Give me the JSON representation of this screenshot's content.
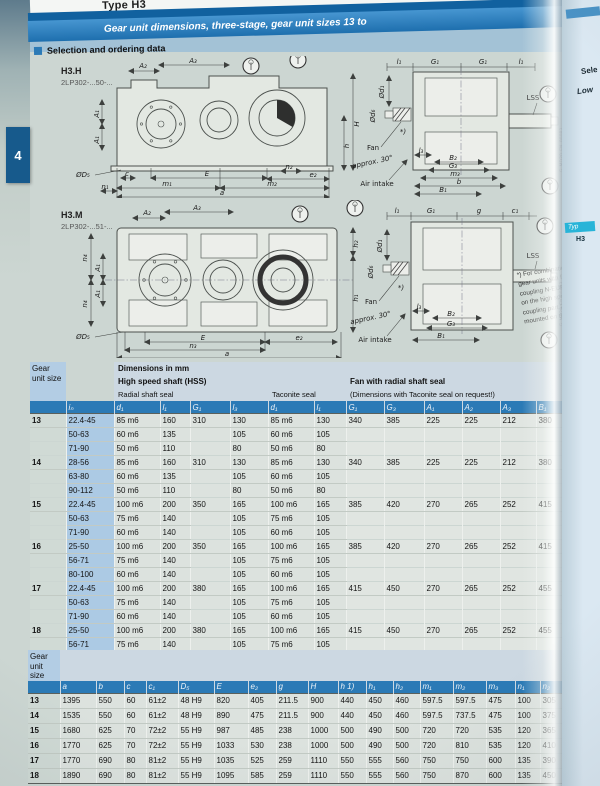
{
  "page": {
    "top_title": "Type H3",
    "banner_title": "Gear unit dimensions, three-stage, gear unit sizes 13 to",
    "section_title": "Selection and ordering data",
    "side_tab": "4",
    "accent_blue": "#2b7ab6",
    "banner_blue": "#2e86c5"
  },
  "next_page": {
    "frag1": "Sele",
    "frag2": "Low",
    "chip": "Typ",
    "chip_sub": "H3"
  },
  "footnote": {
    "lines": [
      "*) For combinations of",
      "gear units with fan and",
      "coupling N-EUPEX-H",
      "on the high speed shaft",
      "coupling part 2/8 must be",
      "mounted on the motor shaft"
    ]
  },
  "drawings": {
    "h3h": {
      "name": "H3.H",
      "code": "2LP302-...50-...",
      "ref": "G_MD20_EN_00083",
      "labels": {
        "A1": "A₁",
        "A2": "A₂",
        "A3": "A₃",
        "H": "H",
        "h": "h",
        "c": "c",
        "E": "E",
        "n1": "n₁",
        "n2": "n₂",
        "e2": "e₂",
        "D5": "ØD₅",
        "m1": "m₁",
        "m2": "m₂",
        "a": "a",
        "l1": "l₁",
        "G1": "G₁",
        "l3": "l₃",
        "LSS": "LSS",
        "d1": "Ød₁",
        "d6": "Ød₆",
        "fan": "Fan",
        "approx": "approx. 30°",
        "air": "Air intake",
        "B1": "B₁",
        "B2": "B₂",
        "G3": "G₃",
        "m3": "m₃",
        "b": "b",
        "star": "*)"
      }
    },
    "h3m": {
      "name": "H3.M",
      "code": "2LP302-...51-...",
      "ref": "G_MD20_EN_00083",
      "labels": {
        "A1": "A₁",
        "A2": "A₂",
        "A3": "A₃",
        "n4": "n₄",
        "h1": "h₁",
        "h2": "h₂",
        "E": "E",
        "n3": "n₃",
        "e2": "e₂",
        "D5": "ØD₅",
        "a": "a",
        "l1": "l₁",
        "G1": "G₁",
        "g": "g",
        "c1": "c₁",
        "l3": "l₃",
        "LSS": "LSS",
        "d1": "Ød₁",
        "d6": "Ød₆",
        "fan": "Fan",
        "approx": "approx. 30°",
        "air": "Air intake",
        "B1": "B₁",
        "B2": "B₂",
        "G3": "G₃",
        "star": "*)"
      }
    }
  },
  "table1": {
    "corner": "Gear unit size",
    "band1": "Dimensions in mm",
    "band2": "High speed shaft (HSS)",
    "band2b": "Fan with radial shaft seal",
    "band3a": "Radial shaft seal",
    "band3b": "Taconite seal",
    "band3c": "(Dimensions with Taconite seal on request!)",
    "cols": [
      "iₙ",
      "d₁",
      "l₁",
      "G₁",
      "l₃",
      "d₁",
      "l₁",
      "G₁",
      "G₃",
      "A₁",
      "A₂",
      "A₃",
      "B₁",
      "B₂"
    ],
    "rows": [
      [
        "13",
        "22.4-45",
        "85 m6",
        "160",
        "310",
        "130",
        "85 m6",
        "130",
        "340",
        "385",
        "225",
        "225",
        "212",
        "380",
        "195"
      ],
      [
        "",
        "50-63",
        "60 m6",
        "135",
        "",
        "105",
        "60 m6",
        "105",
        "",
        "",
        "",
        "",
        "",
        "",
        ""
      ],
      [
        "",
        "71-90",
        "50 m6",
        "110",
        "",
        "80",
        "50 m6",
        "80",
        "",
        "",
        "",
        "",
        "",
        "",
        ""
      ],
      [
        "14",
        "28-56",
        "85 m6",
        "160",
        "310",
        "130",
        "85 m6",
        "130",
        "340",
        "385",
        "225",
        "225",
        "212",
        "380",
        "195"
      ],
      [
        "",
        "63-80",
        "60 m6",
        "135",
        "",
        "105",
        "60 m6",
        "105",
        "",
        "",
        "",
        "",
        "",
        "",
        ""
      ],
      [
        "",
        "90-112",
        "50 m6",
        "110",
        "",
        "80",
        "50 m6",
        "80",
        "",
        "",
        "",
        "",
        "",
        "",
        ""
      ],
      [
        "15",
        "22.4-45",
        "100 m6",
        "200",
        "350",
        "165",
        "100 m6",
        "165",
        "385",
        "420",
        "270",
        "265",
        "252",
        "415",
        "205"
      ],
      [
        "",
        "50-63",
        "75 m6",
        "140",
        "",
        "105",
        "75 m6",
        "105",
        "",
        "",
        "",
        "",
        "",
        "",
        ""
      ],
      [
        "",
        "71-90",
        "60 m6",
        "140",
        "",
        "105",
        "60 m6",
        "105",
        "",
        "",
        "",
        "",
        "",
        "",
        ""
      ],
      [
        "16",
        "25-50",
        "100 m6",
        "200",
        "350",
        "165",
        "100 m6",
        "165",
        "385",
        "420",
        "270",
        "265",
        "252",
        "415",
        "205"
      ],
      [
        "",
        "56-71",
        "75 m6",
        "140",
        "",
        "105",
        "75 m6",
        "105",
        "",
        "",
        "",
        "",
        "",
        "",
        ""
      ],
      [
        "",
        "80-100",
        "60 m6",
        "140",
        "",
        "105",
        "60 m6",
        "105",
        "",
        "",
        "",
        "",
        "",
        "",
        ""
      ],
      [
        "17",
        "22.4-45",
        "100 m6",
        "200",
        "380",
        "165",
        "100 m6",
        "165",
        "415",
        "450",
        "270",
        "265",
        "252",
        "455",
        "235"
      ],
      [
        "",
        "50-63",
        "75 m6",
        "140",
        "",
        "105",
        "75 m6",
        "105",
        "",
        "",
        "",
        "",
        "",
        "",
        ""
      ],
      [
        "",
        "71-90",
        "60 m6",
        "140",
        "",
        "105",
        "60 m6",
        "105",
        "",
        "",
        "",
        "",
        "",
        "",
        ""
      ],
      [
        "18",
        "25-50",
        "100 m6",
        "200",
        "380",
        "165",
        "100 m6",
        "165",
        "415",
        "450",
        "270",
        "265",
        "252",
        "455",
        "235"
      ],
      [
        "",
        "56-71",
        "75 m6",
        "140",
        "",
        "105",
        "75 m6",
        "105",
        "",
        "",
        "",
        "",
        "",
        "",
        ""
      ],
      [
        "",
        "80-100",
        "60 m6",
        "140",
        "",
        "105",
        "60 m6",
        "105",
        "",
        "",
        "",
        "",
        "",
        "",
        ""
      ]
    ]
  },
  "table2": {
    "corner": "Gear unit size",
    "cols": [
      "a",
      "b",
      "c",
      "c₁",
      "D₅",
      "E",
      "e₂",
      "g",
      "H",
      "h 1)",
      "h₁",
      "h₂",
      "m₁",
      "m₂",
      "m₃",
      "n₁",
      "n₂",
      "n₃",
      "n₄"
    ],
    "rows": [
      [
        "13",
        "1395",
        "550",
        "60",
        "61±2",
        "48 H9",
        "820",
        "405",
        "211.5",
        "900",
        "440",
        "450",
        "460",
        "597.5",
        "597.5",
        "475",
        "100",
        "305",
        "940",
        "340"
      ],
      [
        "14",
        "1535",
        "550",
        "60",
        "61±2",
        "48 H9",
        "890",
        "475",
        "211.5",
        "900",
        "440",
        "450",
        "460",
        "597.5",
        "737.5",
        "475",
        "100",
        "375",
        "1010",
        "340"
      ],
      [
        "15",
        "1680",
        "625",
        "70",
        "72±2",
        "55 H9",
        "987",
        "485",
        "238",
        "1000",
        "500",
        "490",
        "500",
        "720",
        "720",
        "535",
        "120",
        "365",
        "1135",
        "375"
      ],
      [
        "16",
        "1770",
        "625",
        "70",
        "72±2",
        "55 H9",
        "1033",
        "530",
        "238",
        "1000",
        "500",
        "490",
        "500",
        "720",
        "810",
        "535",
        "120",
        "410",
        "1180",
        "375"
      ],
      [
        "17",
        "1770",
        "690",
        "80",
        "81±2",
        "55 H9",
        "1035",
        "525",
        "259",
        "1110",
        "550",
        "555",
        "560",
        "750",
        "750",
        "600",
        "135",
        "390",
        "1175",
        "405"
      ],
      [
        "18",
        "1890",
        "690",
        "80",
        "81±2",
        "55 H9",
        "1095",
        "585",
        "259",
        "1110",
        "550",
        "555",
        "560",
        "750",
        "870",
        "600",
        "135",
        "450",
        "1295",
        "425"
      ]
    ]
  }
}
